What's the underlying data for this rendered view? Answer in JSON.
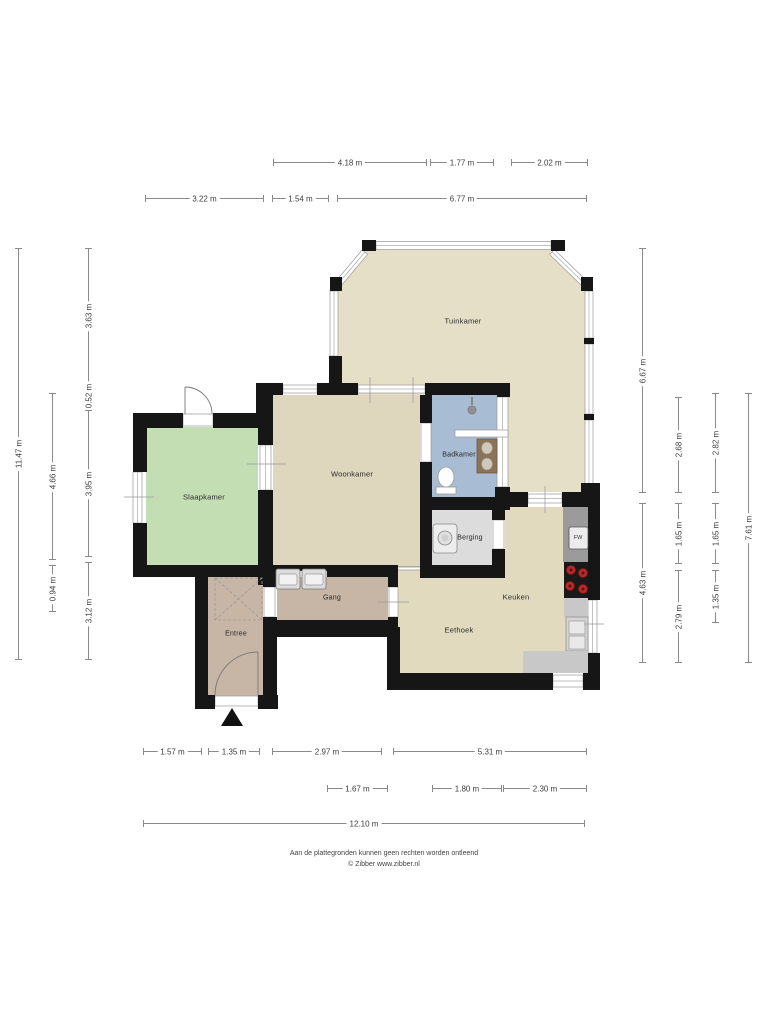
{
  "plan": {
    "rooms": {
      "tuinkamer": "Tuinkamer",
      "woonkamer": "Woonkamer",
      "slaapkamer": "Slaapkamer",
      "badkamer": "Badkamer",
      "berging": "Berging",
      "gang": "Gang",
      "entree": "Entree",
      "eethoek": "Eethoek",
      "keuken": "Keuken"
    },
    "appliance_label": "FW"
  },
  "colors": {
    "wall": "#161616",
    "tuinkamer": "#e6dfc8",
    "woonkamer": "#ded6bd",
    "eethoek": "#e2dabf",
    "slaapkamer": "#c4deb4",
    "badkamer": "#a8bcd3",
    "berging": "#dcdcdc",
    "hal": "#c7b6a6",
    "counter_dark": "#9b9b9b",
    "counter_light": "#c8c8c8",
    "cooktop": "#191919",
    "burner": "#b92a2a"
  },
  "dims": {
    "t1a": "4.18 m",
    "t1b": "1.77 m",
    "t1c": "2.02 m",
    "t2a": "3.22 m",
    "t2b": "1.54 m",
    "t2c": "6.77 m",
    "l1": "11.47 m",
    "l2a": "4.66 m",
    "l2b": "0.94 m",
    "l3a": "3.63 m",
    "l3b": "0.52 m",
    "l3c": "3.95 m",
    "l3d": "3.12 m",
    "r1a": "6.67 m",
    "r1b": "4.63 m",
    "r2a": "2.68 m",
    "r2b": "1.65 m",
    "r2c": "2.79 m",
    "r3a": "2.82 m",
    "r3b": "1.65 m",
    "r3c": "1.35 m",
    "r4": "7.61 m",
    "b1a": "1.57 m",
    "b1b": "1.35 m",
    "b1c": "2.97 m",
    "b1d": "5.31 m",
    "b2a": "1.67 m",
    "b2b": "1.80 m",
    "b2c": "2.30 m",
    "b3": "12.10 m"
  },
  "footer": {
    "line1": "Aan de plattegronden kunnen geen rechten worden ontleend",
    "line2": "© Zibber www.zibber.nl"
  }
}
